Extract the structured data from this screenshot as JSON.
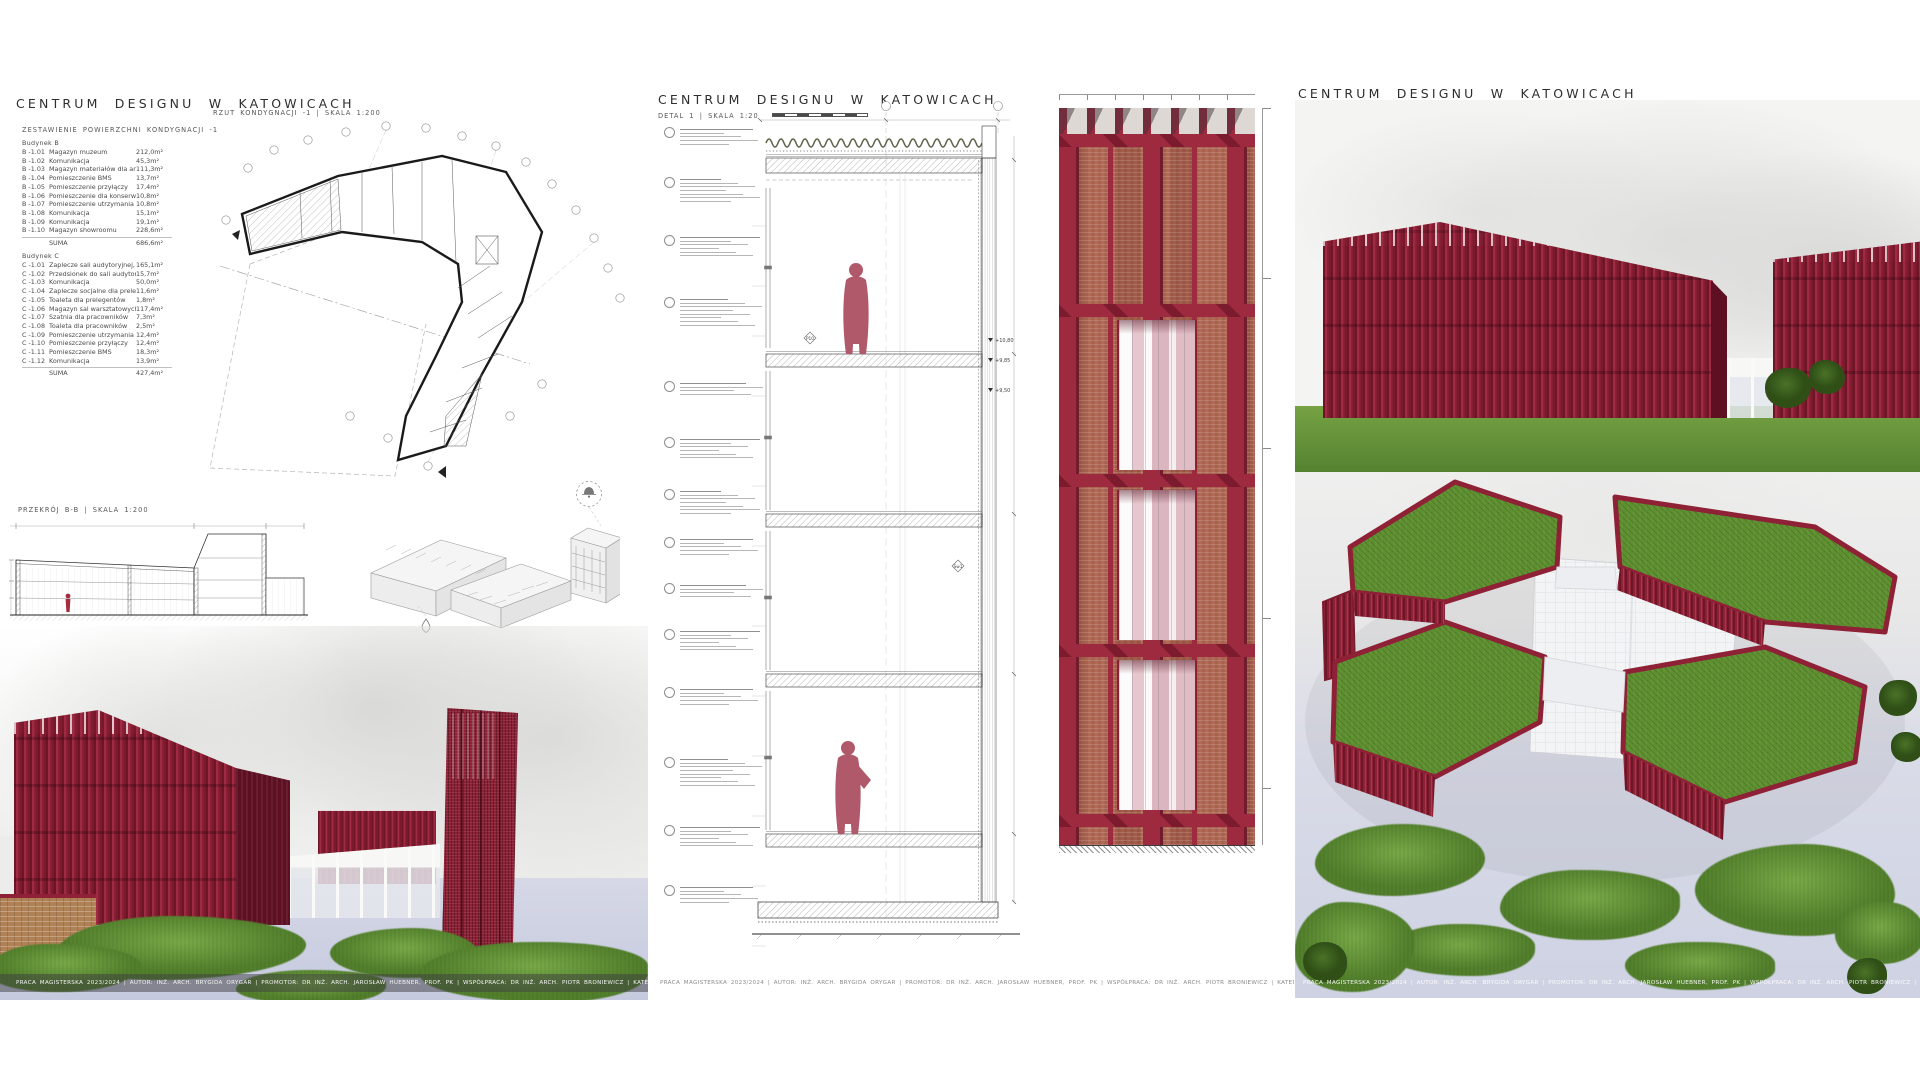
{
  "page": {
    "footer": "PRACA MAGISTERSKA 2023/2024 | AUTOR: INŻ. ARCH. BRYGIDA ORYGAR | PROMOTOR: DR INŻ. ARCH. JAROSŁAW HUEBNER, PROF. PK | WSPÓŁPRACA: DR INŻ. ARCH. PIOTR BRONIEWICZ | KATEDRA KSZTAŁTOWANIA ŚRODOWISKA MIESZKANIOWEGO A-3"
  },
  "colors": {
    "accent_crimson": "#9e2a40",
    "brick": "#b26a56",
    "green_roof": "#5e9030",
    "pavement": "#cfd3e4",
    "figure_red": "#b0596a"
  },
  "left_panel": {
    "title": "CENTRUM DESIGNU W KATOWICACH",
    "table_heading": "ZESTAWIENIE POWIERZCHNI KONDYGNACJI -1",
    "plan_label": "RZUT KONDYGNACJI -1 | SKALA 1:200",
    "section_label": "PRZEKRÓJ B-B | SKALA 1:200",
    "building_b": {
      "label": "Budynek B",
      "rows": [
        [
          "B -1.01",
          "Magazyn muzeum",
          "212,0m²"
        ],
        [
          "B -1.02",
          "Komunikacja",
          "45,3m²"
        ],
        [
          "B -1.03",
          "Magazyn materiałów dla artystów",
          "111,3m²"
        ],
        [
          "B -1.04",
          "Pomieszczenie BMS",
          "13,7m²"
        ],
        [
          "B -1.05",
          "Pomieszczenie przyłączy",
          "17,4m²"
        ],
        [
          "B -1.06",
          "Pomieszczenie dla konserwatora",
          "10,8m²"
        ],
        [
          "B -1.07",
          "Pomieszczenie utrzymania porządku",
          "10,8m²"
        ],
        [
          "B -1.08",
          "Komunikacja",
          "15,1m²"
        ],
        [
          "B -1.09",
          "Komunikacja",
          "19,1m²"
        ],
        [
          "B -1.10",
          "Magazyn showroomu",
          "228,6m²"
        ]
      ],
      "suma": {
        "label": "SUMA",
        "value": "686,6m²"
      }
    },
    "building_c": {
      "label": "Budynek C",
      "rows": [
        [
          "C -1.01",
          "Zaplecze sali audytoryjnej, magazyn mebli",
          "165,1m²"
        ],
        [
          "C -1.02",
          "Przedsionek do sali audytoryjnej",
          "15,7m²"
        ],
        [
          "C -1.03",
          "Komunikacja",
          "50,0m²"
        ],
        [
          "C -1.04",
          "Zaplecze socjalne dla prelegentów",
          "11,6m²"
        ],
        [
          "C -1.05",
          "Toaleta dla prelegentów",
          "1,8m²"
        ],
        [
          "C -1.06",
          "Magazyn sal warsztatowych",
          "117,4m²"
        ],
        [
          "C -1.07",
          "Szatnia dla pracowników",
          "7,3m²"
        ],
        [
          "C -1.08",
          "Toaleta dla pracowników",
          "2,5m²"
        ],
        [
          "C -1.09",
          "Pomieszczenie utrzymania porządku",
          "12,4m²"
        ],
        [
          "C -1.10",
          "Pomieszczenie przyłączy",
          "12,4m²"
        ],
        [
          "C -1.11",
          "Pomieszczenie BMS",
          "18,3m²"
        ],
        [
          "C -1.12",
          "Komunikacja",
          "13,9m²"
        ]
      ],
      "suma": {
        "label": "SUMA",
        "value": "427,4m²"
      }
    }
  },
  "middle_panel": {
    "title": "CENTRUM DESIGNU W KATOWICACH",
    "detail_label": "DETAL 1 | SKALA 1:20",
    "markers": {
      "p10": "P10",
      "sw1": "Sw1"
    },
    "elevations": [
      "+10,80",
      "+9,85",
      "+9,50"
    ],
    "callouts": [
      {
        "y": 126,
        "lines": 5
      },
      {
        "y": 176,
        "lines": 7
      },
      {
        "y": 234,
        "lines": 6
      },
      {
        "y": 296,
        "lines": 8
      },
      {
        "y": 380,
        "lines": 4
      },
      {
        "y": 436,
        "lines": 6
      },
      {
        "y": 488,
        "lines": 7
      },
      {
        "y": 536,
        "lines": 5
      },
      {
        "y": 582,
        "lines": 4
      },
      {
        "y": 628,
        "lines": 6
      },
      {
        "y": 686,
        "lines": 5
      },
      {
        "y": 756,
        "lines": 8
      },
      {
        "y": 824,
        "lines": 6
      },
      {
        "y": 884,
        "lines": 5
      }
    ]
  },
  "right_panel": {
    "title": "CENTRUM DESIGNU W KATOWICACH"
  }
}
